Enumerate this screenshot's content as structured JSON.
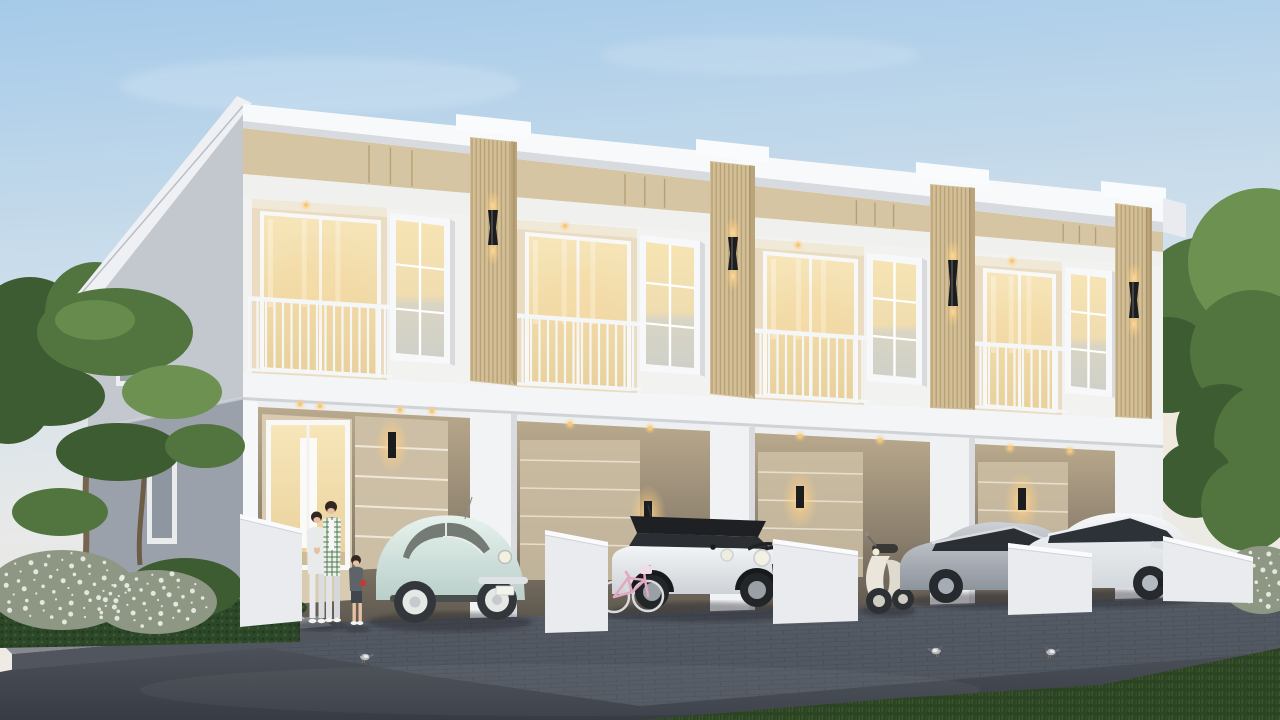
{
  "meta": {
    "description": "Photorealistic dusk rendering of a modern two-storey townhouse row with four units, carports with vehicles, a family of three, pigeons and landscaped garden",
    "time_of_day": "dusk",
    "style": "modern minimal white with wood slat accents"
  },
  "building": {
    "units": 4,
    "floors": 2,
    "features": [
      "stepped white parapet roof",
      "beige accent band",
      "wood slat pillars",
      "black up-down wall sconces lit",
      "recessed balconies with white railings",
      "white grid windows glowing warm",
      "ground floor carports",
      "glass entrance door",
      "recessed warm downlights",
      "low white fence walls"
    ]
  },
  "vehicles": [
    {
      "type": "vw-beetle-classic",
      "color_name": "pastel blue",
      "location": "carport 1"
    },
    {
      "type": "mini-cooper",
      "color_name": "white with black roof and bonnet stripes",
      "location": "carport 2"
    },
    {
      "type": "kids-bicycle",
      "color_name": "pink",
      "location": "carport 2"
    },
    {
      "type": "vespa-scooter",
      "color_name": "cream",
      "location": "carport 3"
    },
    {
      "type": "crossover-ev",
      "color_name": "silver",
      "location": "carport 3"
    },
    {
      "type": "compact-suv",
      "color_name": "white",
      "location": "carport 4"
    }
  ],
  "people": [
    {
      "role": "mother",
      "outfit": "light gray hoodie and pants"
    },
    {
      "role": "father",
      "outfit": "white cardigan with green check"
    },
    {
      "role": "boy",
      "outfit": "dark tee and shorts, holding red toy"
    }
  ],
  "animals": {
    "pigeons": 3
  },
  "landscape": [
    "cloud-pruned topiary trees",
    "white flowering shrubs",
    "trimmed hedge",
    "flagstone curb",
    "dark asphalt driveway",
    "brick paver apron",
    "lawn strip"
  ],
  "colors": {
    "sky_top": "#a5cae9",
    "sky_mid": "#cfdfeb",
    "sky_horizon": "#f1ebe2",
    "facade": "#f2f2f1",
    "fascia": "#f8f9fa",
    "facade_shade": "#e4e6e9",
    "soffit_shadow": "#d7dade",
    "slab_white": "#f4f5f6",
    "beige_band": "#d5c5a3",
    "wood_slat": "#d3bf97",
    "wood_slat_line": "#b1976c",
    "gable_upper": "#c3c7ce",
    "gable_lower": "#9ba1ab",
    "roof_edge": "#eef0f3",
    "glass_warm_top": "#f7e6ba",
    "glass_warm_bottom": "#e9d09a",
    "glass_cool": "#cfd0c8",
    "railing": "#f4f6f7",
    "recess_wall": "#eadcc2",
    "recess_ceiling": "#f1e9d8",
    "carport_wall": "#cdbfa5",
    "carport_groove": "#efe8d8",
    "carport_dark": "#8a7f6e",
    "carport_deep": "#675f53",
    "sconce_black": "#1c1d1f",
    "glow": "#ffd79c",
    "driveway_top": "#5c6169",
    "driveway_bottom": "#373c44",
    "paver_line": "#4a505a",
    "curb_top": "#868a90",
    "curb_face": "#51555d",
    "curb_joint": "#c6c9ce",
    "hedge": "#2d4828",
    "hedge_dark": "#203722",
    "grass": "#2c4424",
    "grass_light": "#3f6030",
    "tree_main": "#527540",
    "tree_dark": "#3e5c31",
    "tree_light": "#6c9150",
    "trunk": "#75654e",
    "flower_base": "#8e9784",
    "flower_white": "#edefe8",
    "beetle": "#dcebe6",
    "beetle_shade": "#b7cdc8",
    "mini_body": "#edeff1",
    "mini_roof": "#1e2023",
    "crossover": "#b4b9c0",
    "suv": "#eff1f3",
    "vespa": "#eae6dc",
    "bicycle": "#e2a8bf",
    "pigeon": "#b5bac0",
    "skin": "#e6c0a2",
    "hair": "#32281f",
    "mom_outfit": "#e9eaec",
    "dad_outfit": "#eef0ec",
    "dad_check": "#4e7a50",
    "boy_shirt": "#5c6369",
    "boy_shorts": "#3f464d",
    "toy_red": "#c63a30",
    "tire": "#33373b",
    "chrome": "#dfe2e4",
    "window_dark": "#2b2e33",
    "shadow": "#20242a"
  }
}
